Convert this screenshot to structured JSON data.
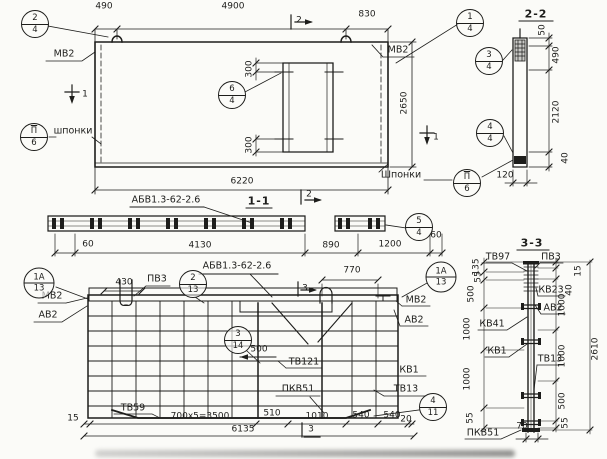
{
  "plan": {
    "dims": {
      "left": "490",
      "mid": "4900",
      "right": "830",
      "total": "6220",
      "height": "2650",
      "door_top": "300",
      "door_bottom": "300"
    },
    "labels": {
      "mv2_left": "МВ2",
      "mv2_right": "МВ2",
      "keys_left": "шпонки",
      "keys_right": "Шпонки"
    },
    "cuts": {
      "top": "2",
      "left": "1",
      "right": "1"
    },
    "callouts": {
      "c24": {
        "n": "2",
        "s": "4"
      },
      "c14": {
        "n": "1",
        "s": "4"
      },
      "c64": {
        "n": "6",
        "s": "4"
      },
      "k6l": {
        "n": "П",
        "s": "6"
      },
      "k6r": {
        "n": "П",
        "s": "6"
      }
    }
  },
  "section22": {
    "title": "2-2",
    "dims": {
      "d50": "50",
      "d490": "490",
      "d2120": "2120",
      "d40": "40",
      "d120": "120"
    },
    "callouts": {
      "c34": {
        "n": "3",
        "s": "4"
      },
      "c44": {
        "n": "4",
        "s": "4"
      }
    }
  },
  "section11": {
    "title": "1-1",
    "mark": "АБВ1.3-62-2.6",
    "cut": "2",
    "dims": {
      "d60l": "60",
      "d4130": "4130",
      "d890": "890",
      "d1200": "1200",
      "d60r": "60"
    },
    "callouts": {
      "c54": {
        "n": "5",
        "s": "4"
      }
    }
  },
  "reinforcement": {
    "title": "АБВ1.3-62-2.6",
    "cuts": {
      "top": "3",
      "bottom": "3"
    },
    "labels": {
      "pv3": "ПВ3",
      "mv2_left": "МВ2",
      "av2_left": "АВ2",
      "mv2_right": "МВ2",
      "av2_right": "АВ2",
      "tv121": "ТВ121",
      "kv1": "КВ1",
      "pkv51": "ПКВ51",
      "tv13": "ТВ13",
      "tv59": "ТВ59"
    },
    "dims": {
      "d430": "430",
      "d770": "770",
      "d500": "500",
      "d15": "15",
      "pitch": "700х5=3500",
      "d510": "510",
      "d1010": "1010",
      "d540a": "540",
      "d540b": "540",
      "d20": "20",
      "total": "6135"
    },
    "callouts": {
      "c1a13l": {
        "n": "1А",
        "s": "13"
      },
      "c213": {
        "n": "2",
        "s": "13"
      },
      "c1a13r": {
        "n": "1А",
        "s": "13"
      },
      "c314": {
        "n": "3",
        "s": "14"
      },
      "c411": {
        "n": "4",
        "s": "11"
      }
    }
  },
  "section33": {
    "title": "3-3",
    "labels": {
      "tv97": "ТВ97",
      "pv3": "ПВ3",
      "kv23": "КВ23",
      "av2": "АВ2",
      "kv41": "КВ41",
      "kv1": "КВ1",
      "tv13": "ТВ13",
      "pkv51": "ПКВ51"
    },
    "dims_left": {
      "d135": "135",
      "d55_top": "55",
      "d500": "500",
      "d1000a": "1000",
      "d1000b": "1000",
      "d55_bottom": "55"
    },
    "dims_right": {
      "d15": "15",
      "d40": "40",
      "d1000a": "1000",
      "d1000b": "1000",
      "d500": "500",
      "d55": "55",
      "total": "2610",
      "d70": "70"
    }
  }
}
